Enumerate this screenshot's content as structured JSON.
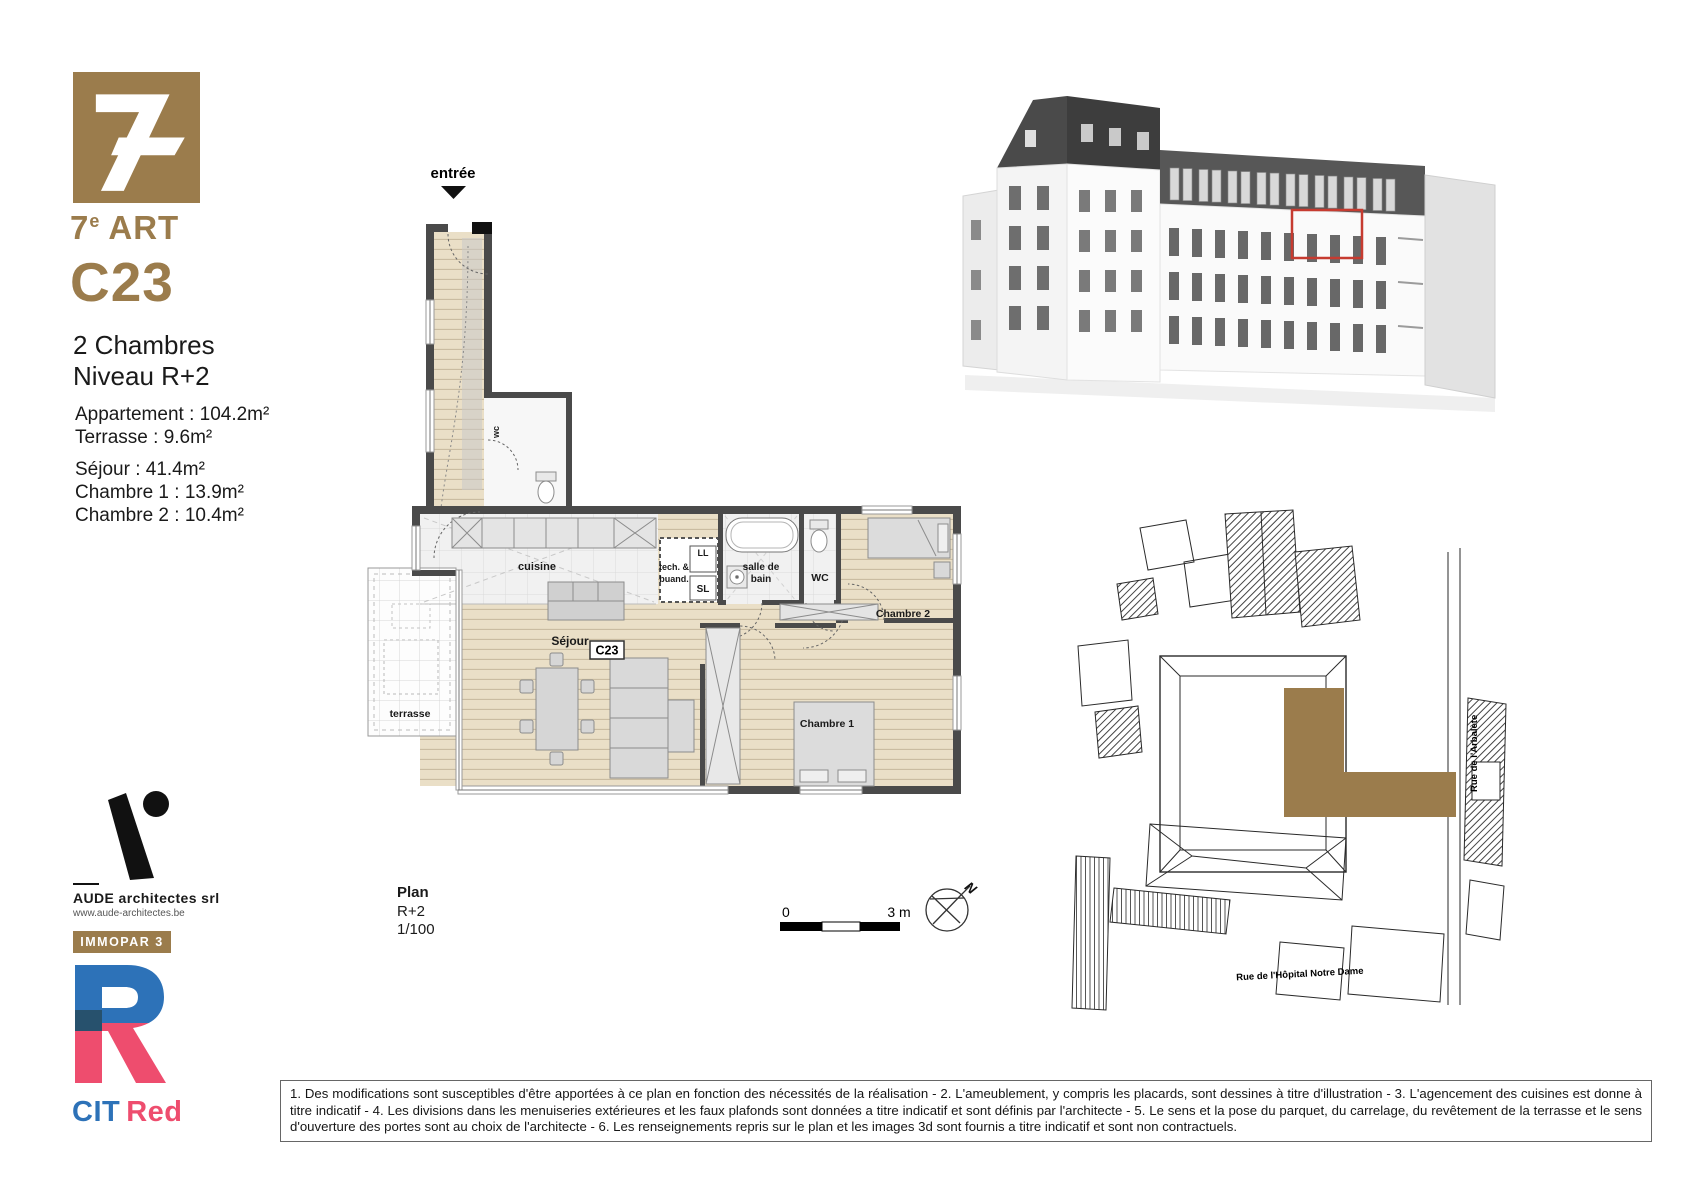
{
  "brand": {
    "name_num": "7",
    "name_sup": "e",
    "name_word": "ART",
    "gold": "#9b7c4c"
  },
  "unit": {
    "code": "C23",
    "type": "2 Chambres",
    "level": "Niveau R+2",
    "areas": [
      "Appartement : 104.2m²",
      "Terrasse : 9.6m²"
    ],
    "room_areas": [
      "Séjour : 41.4m²",
      "Chambre 1 : 13.9m²",
      "Chambre 2 : 10.4m²"
    ]
  },
  "plan": {
    "labels": {
      "entry": "entrée",
      "wc_small": "wc",
      "cuisine": "cuisine",
      "tech1": "tech. &",
      "tech2": "buand.",
      "ll": "LL",
      "sl": "SL",
      "bath1": "salle de",
      "bath2": "bain",
      "wc": "WC",
      "sejour": "Séjour",
      "unit_tag": "C23",
      "ch1": "Chambre 1",
      "ch2": "Chambre 2",
      "terrace": "terrasse"
    },
    "caption": {
      "title": "Plan",
      "level": "R+2",
      "scale": "1/100"
    },
    "scale_bar": {
      "zero": "0",
      "three": "3 m"
    },
    "north": "N"
  },
  "siteplan": {
    "street_right": "Rue de l'Arbalète",
    "street_bottom": "Rue de l'Hôpital Notre Dame",
    "highlight_color": "#9b7c4c"
  },
  "render": {
    "highlight_color": "#c63b30"
  },
  "partners": {
    "architect": {
      "name": "AUDE architectes srl",
      "website": "www.aude-architectes.be"
    },
    "immopar_label": "IMMOPAR 3",
    "cit": "CIT",
    "red": "Red",
    "blue": "#2d72b8",
    "pink": "#ee4d6e"
  },
  "disclaimer": {
    "text": "1. Des modifications sont susceptibles d'être apportées à ce plan en fonction des nécessités de la réalisation - 2. L'ameublement, y compris les placards, sont dessines à titre d'illustration - 3. L'agencement des cuisines est donne à titre indicatif - 4. Les divisions dans les menuiseries extérieures et les faux plafonds sont données a titre indicatif et sont définis par l'architecte - 5. Le sens et la pose du parquet, du carrelage, du revêtement de la terrasse et le sens d'ouverture des portes sont au choix de l'architecte - 6. Les renseignements repris sur le plan et les images 3d sont fournis a titre indicatif et sont non contractuels."
  }
}
